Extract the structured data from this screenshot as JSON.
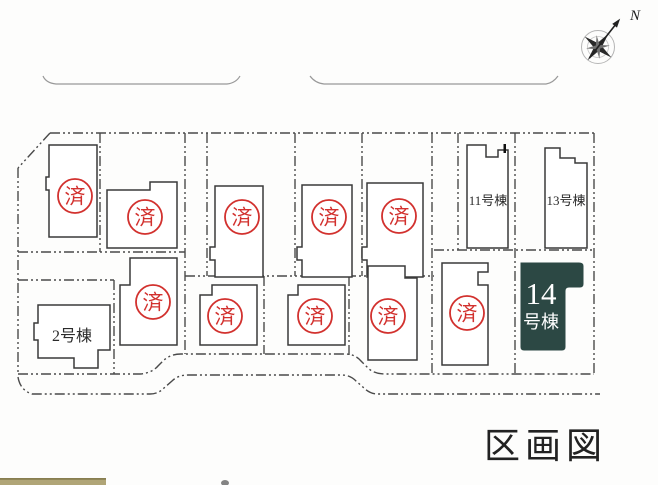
{
  "title": "区画図",
  "compass": {
    "north_label": "N"
  },
  "stamp": {
    "char": "済",
    "color": "#d2312e"
  },
  "colors": {
    "highlight_fill": "#2c4844",
    "highlight_text": "#ffffff",
    "boundary_line": "#4a4a4a",
    "building_stroke": "#3a3a3a",
    "road_line": "#999999",
    "legend_bar": "#b0a577",
    "legend_bar_edge": "#887e51",
    "title_color": "#222222"
  },
  "lots": [
    {
      "id": "sold-1",
      "status": "sold"
    },
    {
      "id": "sold-2",
      "status": "sold"
    },
    {
      "id": "sold-3",
      "status": "sold"
    },
    {
      "id": "sold-4",
      "status": "sold"
    },
    {
      "id": "sold-5",
      "status": "sold"
    },
    {
      "id": "sold-6",
      "status": "sold"
    },
    {
      "id": "sold-7",
      "status": "sold"
    },
    {
      "id": "sold-8",
      "status": "sold"
    },
    {
      "id": "sold-9",
      "status": "sold"
    },
    {
      "id": "sold-10",
      "status": "sold"
    },
    {
      "id": "lot-2",
      "label": "2号棟",
      "status": "available"
    },
    {
      "id": "lot-11",
      "label": "11号棟",
      "status": "available"
    },
    {
      "id": "lot-13",
      "label": "13号棟",
      "status": "available"
    },
    {
      "id": "lot-14",
      "label_number": "14",
      "label_suffix": "号棟",
      "status": "highlighted"
    }
  ]
}
